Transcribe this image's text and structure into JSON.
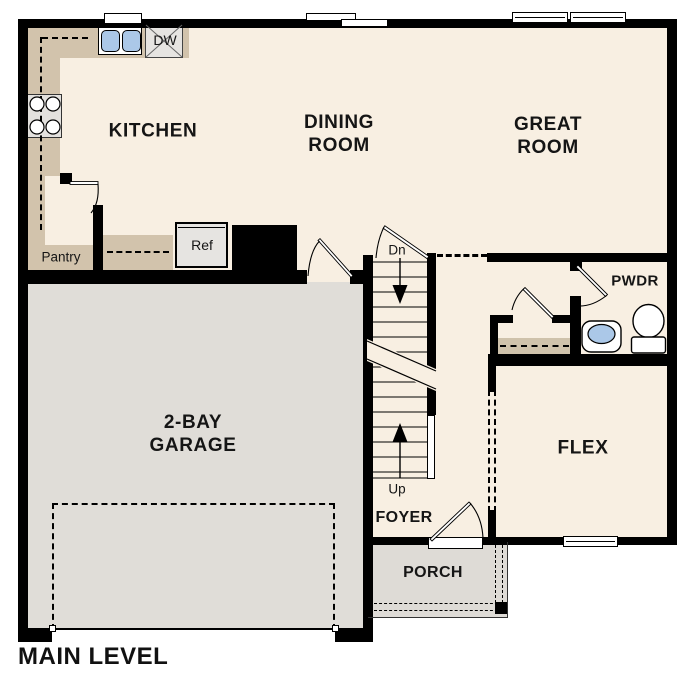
{
  "plan": {
    "title": "MAIN LEVEL",
    "rooms": {
      "kitchen": "KITCHEN",
      "dining_line1": "DINING",
      "dining_line2": "ROOM",
      "great_line1": "GREAT",
      "great_line2": "ROOM",
      "garage_line1": "2-BAY",
      "garage_line2": "GARAGE",
      "flex": "FLEX",
      "pwdr": "PWDR",
      "foyer": "FOYER",
      "porch": "PORCH",
      "pantry": "Pantry"
    },
    "fixtures": {
      "ref": "Ref",
      "dw": "DW"
    },
    "stairs": {
      "down": "Dn",
      "up": "Up"
    },
    "colors": {
      "floor": "#f8efe2",
      "garage_floor": "#e0ddd8",
      "porch_floor": "#dedbd6",
      "counter": "#d2c3ac",
      "shelf": "#cfc2ab",
      "sink_basin": "#abc8e8",
      "appliance": "#e6e4e1",
      "wall": "#000000"
    }
  }
}
